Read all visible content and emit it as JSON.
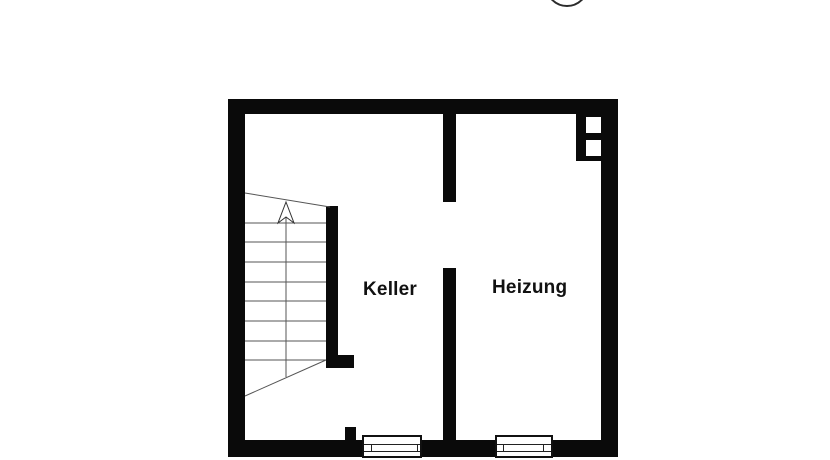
{
  "plan": {
    "type": "basement-floor-plan",
    "rooms": [
      {
        "id": "keller",
        "label": "Keller"
      },
      {
        "id": "heizung",
        "label": "Heizung"
      }
    ],
    "stair": {
      "direction_arrow": "up",
      "tread_count": 8
    },
    "windows_count": 2,
    "flue_openings": 2,
    "colors": {
      "wall": "#0a0a0a",
      "background": "#ffffff",
      "thin_line": "#555555"
    }
  }
}
